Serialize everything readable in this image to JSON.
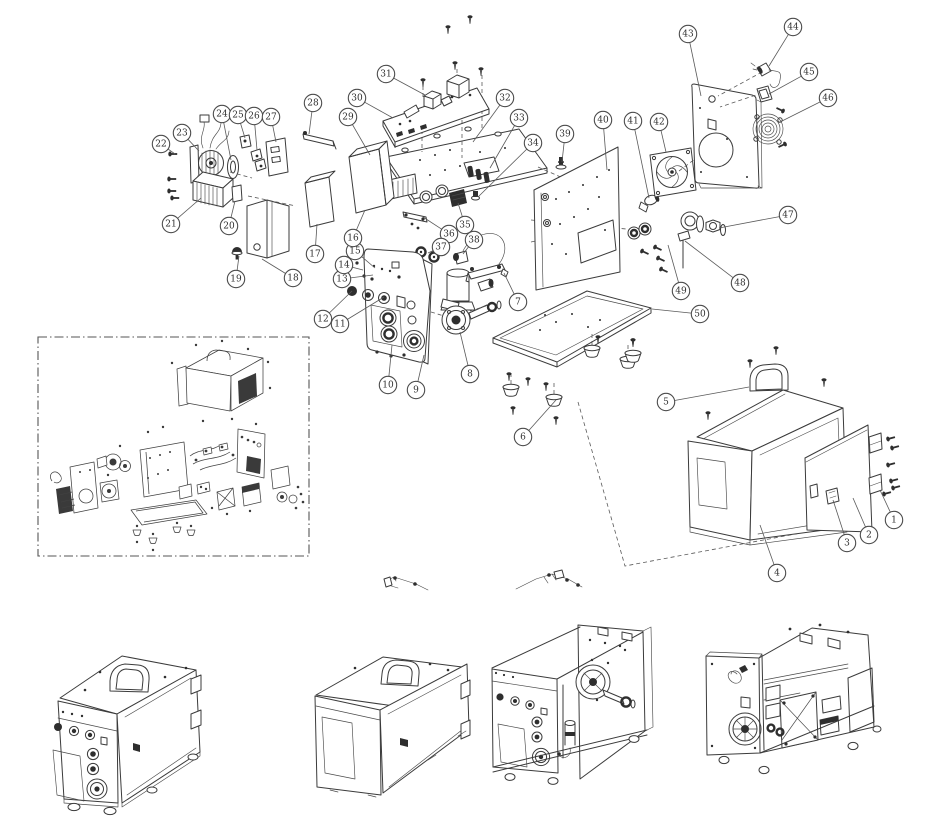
{
  "figure": {
    "kind": "exploded-parts-diagram",
    "background": "#ffffff",
    "line_color": "#3b3b3b",
    "callout_stroke": "#4c4c4c",
    "callout_fill": "#ffffff",
    "callout_radius": 8.7,
    "callout_font_size": 9
  },
  "callouts": [
    {
      "n": "1",
      "cx": 894,
      "cy": 520,
      "tx": 880,
      "ty": 490
    },
    {
      "n": "2",
      "cx": 869,
      "cy": 535,
      "tx": 853,
      "ty": 498
    },
    {
      "n": "3",
      "cx": 847,
      "cy": 543,
      "tx": 833,
      "ty": 500
    },
    {
      "n": "4",
      "cx": 777,
      "cy": 573,
      "tx": 760,
      "ty": 525
    },
    {
      "n": "5",
      "cx": 666,
      "cy": 402,
      "tx": 749,
      "ty": 387
    },
    {
      "n": "6",
      "cx": 523,
      "cy": 437,
      "tx": 556,
      "ty": 400
    },
    {
      "n": "7",
      "cx": 518,
      "cy": 302,
      "tx": 504,
      "ty": 273
    },
    {
      "n": "8",
      "cx": 470,
      "cy": 374,
      "tx": 460,
      "ty": 332
    },
    {
      "n": "9",
      "cx": 416,
      "cy": 390,
      "tx": 424,
      "ty": 355
    },
    {
      "n": "10",
      "cx": 388,
      "cy": 385,
      "tx": 392,
      "ty": 345
    },
    {
      "n": "11",
      "cx": 340,
      "cy": 324,
      "tx": 384,
      "ty": 297
    },
    {
      "n": "12",
      "cx": 323,
      "cy": 319,
      "tx": 352,
      "ty": 291
    },
    {
      "n": "13",
      "cx": 342,
      "cy": 279,
      "tx": 373,
      "ty": 275
    },
    {
      "n": "14",
      "cx": 344,
      "cy": 265,
      "tx": 363,
      "ty": 270
    },
    {
      "n": "15",
      "cx": 355,
      "cy": 251,
      "tx": 375,
      "ty": 268
    },
    {
      "n": "16",
      "cx": 353,
      "cy": 238,
      "tx": 365,
      "ty": 210
    },
    {
      "n": "17",
      "cx": 315,
      "cy": 254,
      "tx": 317,
      "ty": 224
    },
    {
      "n": "18",
      "cx": 293,
      "cy": 278,
      "tx": 262,
      "ty": 259
    },
    {
      "n": "19",
      "cx": 236,
      "cy": 279,
      "tx": 239,
      "ty": 256
    },
    {
      "n": "20",
      "cx": 229,
      "cy": 226,
      "tx": 235,
      "ty": 201
    },
    {
      "n": "21",
      "cx": 171,
      "cy": 224,
      "tx": 201,
      "ty": 198
    },
    {
      "n": "22",
      "cx": 161,
      "cy": 144,
      "tx": 175,
      "ty": 154
    },
    {
      "n": "23",
      "cx": 182,
      "cy": 133,
      "tx": 199,
      "ty": 151
    },
    {
      "n": "24",
      "cx": 222,
      "cy": 114,
      "tx": 231,
      "ty": 160
    },
    {
      "n": "25",
      "cx": 238,
      "cy": 115,
      "tx": 245,
      "ty": 138
    },
    {
      "n": "26",
      "cx": 254,
      "cy": 116,
      "tx": 257,
      "ty": 150
    },
    {
      "n": "27",
      "cx": 271,
      "cy": 117,
      "tx": 276,
      "ty": 142
    },
    {
      "n": "28",
      "cx": 313,
      "cy": 103,
      "tx": 309,
      "ty": 134
    },
    {
      "n": "29",
      "cx": 348,
      "cy": 117,
      "tx": 370,
      "ty": 155
    },
    {
      "n": "30",
      "cx": 357,
      "cy": 98,
      "tx": 393,
      "ty": 118
    },
    {
      "n": "31",
      "cx": 386,
      "cy": 74,
      "tx": 425,
      "ty": 95
    },
    {
      "n": "32",
      "cx": 505,
      "cy": 98,
      "tx": 473,
      "ty": 142
    },
    {
      "n": "33",
      "cx": 519,
      "cy": 118,
      "tx": 490,
      "ty": 168
    },
    {
      "n": "34",
      "cx": 533,
      "cy": 143,
      "tx": 478,
      "ty": 197
    },
    {
      "n": "35",
      "cx": 465,
      "cy": 225,
      "tx": 458,
      "ty": 203
    },
    {
      "n": "36",
      "cx": 449,
      "cy": 234,
      "tx": 423,
      "ty": 217
    },
    {
      "n": "37",
      "cx": 441,
      "cy": 247,
      "tx": 428,
      "ty": 253
    },
    {
      "n": "38",
      "cx": 474,
      "cy": 240,
      "tx": 463,
      "ty": 254
    },
    {
      "n": "39",
      "cx": 565,
      "cy": 134,
      "tx": 562,
      "ty": 162
    },
    {
      "n": "40",
      "cx": 603,
      "cy": 120,
      "tx": 607,
      "ty": 170
    },
    {
      "n": "41",
      "cx": 633,
      "cy": 121,
      "tx": 649,
      "ty": 198
    },
    {
      "n": "42",
      "cx": 659,
      "cy": 122,
      "tx": 666,
      "ty": 152
    },
    {
      "n": "43",
      "cx": 688,
      "cy": 34,
      "tx": 701,
      "ty": 96
    },
    {
      "n": "44",
      "cx": 793,
      "cy": 27,
      "tx": 769,
      "ty": 66
    },
    {
      "n": "45",
      "cx": 809,
      "cy": 72,
      "tx": 769,
      "ty": 94
    },
    {
      "n": "46",
      "cx": 828,
      "cy": 98,
      "tx": 778,
      "ty": 123
    },
    {
      "n": "47",
      "cx": 788,
      "cy": 215,
      "tx": 719,
      "ty": 228
    },
    {
      "n": "48",
      "cx": 740,
      "cy": 283,
      "tx": 685,
      "ty": 241
    },
    {
      "n": "49",
      "cx": 681,
      "cy": 291,
      "tx": 668,
      "ty": 245
    },
    {
      "n": "50",
      "cx": 700,
      "cy": 314,
      "tx": 652,
      "ty": 309
    }
  ]
}
